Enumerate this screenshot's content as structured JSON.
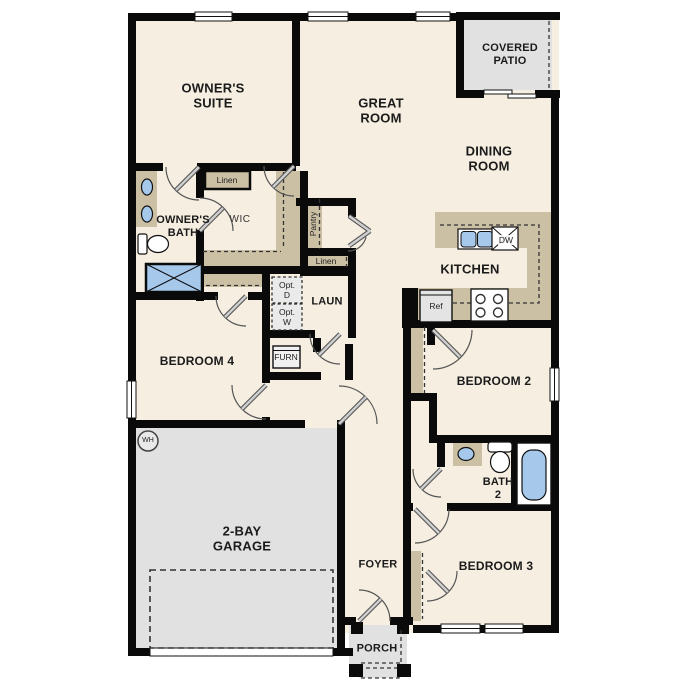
{
  "title": "Single-story floor plan",
  "rooms": {
    "owners_suite": {
      "label": "OWNER'S\nSUITE"
    },
    "great_room": {
      "label": "GREAT\nROOM"
    },
    "covered_patio": {
      "label": "COVERED\nPATIO"
    },
    "dining_room": {
      "label": "DINING\nROOM"
    },
    "kitchen": {
      "label": "KITCHEN"
    },
    "owners_bath": {
      "label": "OWNER'S\nBATH"
    },
    "wic": {
      "label": "WIC"
    },
    "linen_top": {
      "label": "Linen"
    },
    "pantry": {
      "label": "Pantry"
    },
    "linen_hall": {
      "label": "Linen"
    },
    "laundry": {
      "label": "LAUN"
    },
    "opt_dryer": {
      "label": "Opt.\nD"
    },
    "opt_washer": {
      "label": "Opt.\nW"
    },
    "furnace": {
      "label": "FURN"
    },
    "bedroom4": {
      "label": "BEDROOM 4"
    },
    "bedroom2": {
      "label": "BEDROOM 2"
    },
    "bath2": {
      "label": "BATH\n2"
    },
    "bedroom3": {
      "label": "BEDROOM 3"
    },
    "garage": {
      "label": "2-BAY\nGARAGE"
    },
    "foyer": {
      "label": "FOYER"
    },
    "porch": {
      "label": "PORCH"
    }
  },
  "equipment": {
    "water_heater": {
      "label": "WH"
    },
    "refrigerator": {
      "label": "Ref"
    },
    "dishwasher": {
      "label": "DW"
    }
  },
  "colors": {
    "wall": "#0a0a0a",
    "floor": "#f5eee1",
    "cabinet_tan": "#ccc0a4",
    "concrete_gray": "#e1e1e1",
    "optional_gray": "#eaeaea",
    "fixture_blue": "#a6c8eb"
  }
}
